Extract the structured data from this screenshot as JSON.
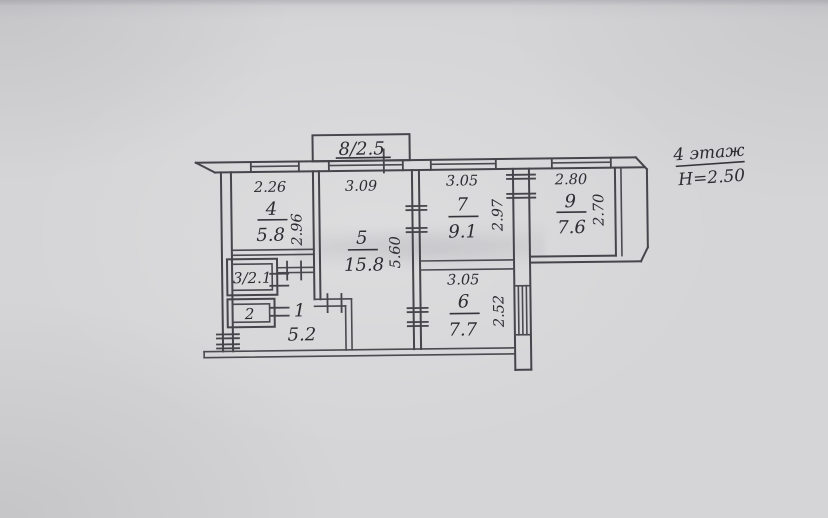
{
  "colors": {
    "paper": "#d5d5d7",
    "ink": "#45454b",
    "text": "#2c2c31"
  },
  "header": {
    "floor_label": "4 этаж",
    "ceiling_height": "H=2.50"
  },
  "balcony": {
    "label": "8/2.5"
  },
  "rooms": {
    "r4": {
      "number": "4",
      "area": "5.8",
      "width": "2.26",
      "depth": "2.96"
    },
    "r5": {
      "number": "5",
      "area": "15.8",
      "width": "3.09",
      "depth": "5.60"
    },
    "r7": {
      "number": "7",
      "area": "9.1",
      "width": "3.05",
      "depth": "2.97"
    },
    "r9": {
      "number": "9",
      "area": "7.6",
      "width": "2.80",
      "depth": "2.70"
    },
    "r6": {
      "number": "6",
      "area": "7.7",
      "width": "3.05",
      "depth": "2.52"
    },
    "r3": {
      "label": "3/2.1"
    },
    "r2": {
      "label": "2"
    },
    "r1": {
      "number": "1",
      "area": "5.2"
    }
  }
}
